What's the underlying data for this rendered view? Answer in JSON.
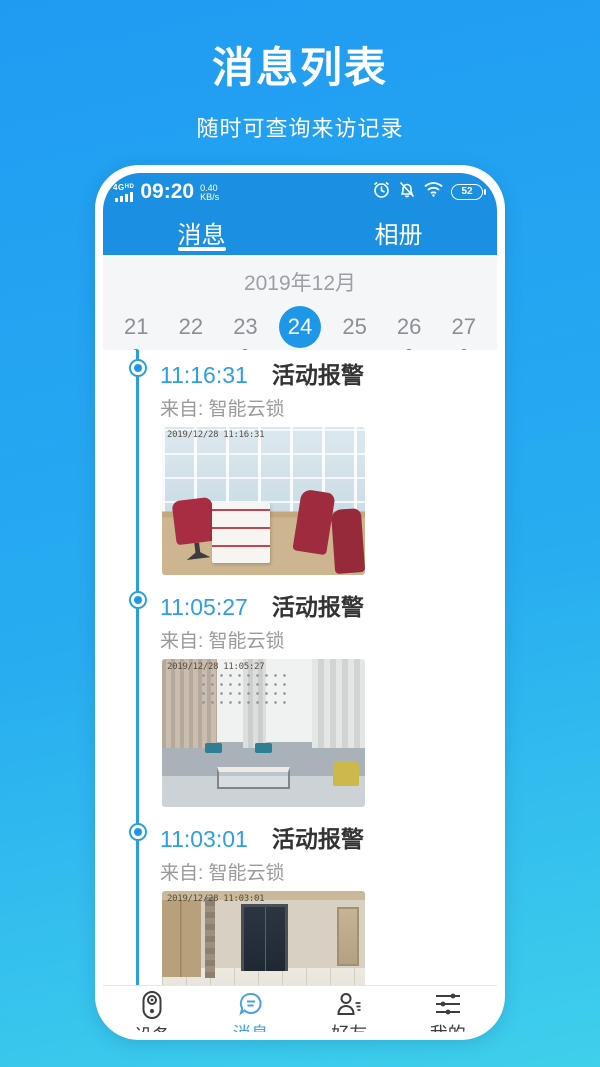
{
  "page": {
    "title": "消息列表",
    "subtitle": "随时可查询来访记录"
  },
  "status": {
    "network": "4G",
    "hd": "HD",
    "time": "09:20",
    "speed": "0.40",
    "speed_unit": "KB/s",
    "battery": "52",
    "icons": [
      "signal-icon",
      "alarm-clock-icon",
      "bell-muted-icon",
      "wifi-icon",
      "battery-icon"
    ]
  },
  "tabs": [
    {
      "label": "消息",
      "active": true
    },
    {
      "label": "相册",
      "active": false
    }
  ],
  "calendar": {
    "month": "2019年12月",
    "days": [
      {
        "day": "21",
        "dot": true,
        "selected": false
      },
      {
        "day": "22",
        "dot": false,
        "selected": false
      },
      {
        "day": "23",
        "dot": true,
        "selected": false
      },
      {
        "day": "24",
        "dot": false,
        "selected": true
      },
      {
        "day": "25",
        "dot": false,
        "selected": false
      },
      {
        "day": "26",
        "dot": true,
        "selected": false
      },
      {
        "day": "27",
        "dot": true,
        "selected": false
      }
    ],
    "accent_color": "#1E97E8"
  },
  "messages": [
    {
      "time": "11:16:31",
      "type": "活动报警",
      "from": "来自: 智能云锁",
      "watermark": "2019/12/28 11:16:31",
      "photo": "office-with-red-chairs"
    },
    {
      "time": "11:05:27",
      "type": "活动报警",
      "from": "来自: 智能云锁",
      "watermark": "2019/12/28 11:05:27",
      "photo": "living-room-gray-sofa"
    },
    {
      "time": "11:03:01",
      "type": "活动报警",
      "from": "来自: 智能云锁",
      "watermark": "2019/12/28 11:03:01",
      "photo": "elevator-hallway"
    },
    {
      "time": "10:57:57",
      "type": "活动报警"
    }
  ],
  "nav": {
    "items": [
      {
        "label": "设备",
        "icon": "device-icon",
        "active": false
      },
      {
        "label": "消息",
        "icon": "message-icon",
        "active": true
      },
      {
        "label": "好友",
        "icon": "friends-icon",
        "active": false
      },
      {
        "label": "我的",
        "icon": "profile-icon",
        "active": false
      }
    ],
    "active_color": "#4AA3E0"
  },
  "colors": {
    "background_top": "#209BF2",
    "background_bottom": "#3FD0EB",
    "app_header": "#1B8FE2",
    "timeline": "#2BA0D8",
    "time_text": "#2E9FE0"
  }
}
